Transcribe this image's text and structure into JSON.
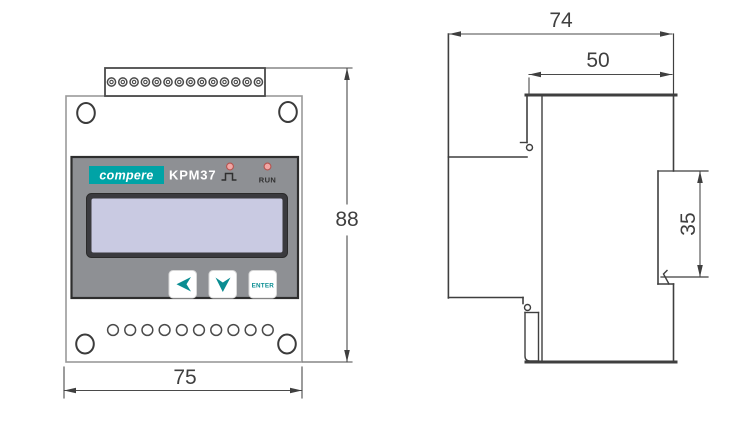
{
  "front": {
    "brand": "compere",
    "model": "KPM37",
    "leds": [
      {
        "name": "pulse",
        "icon": "pulse-waveform-icon"
      },
      {
        "name": "run",
        "label": "RUN"
      }
    ],
    "buttons": [
      {
        "name": "left",
        "icon": "left-arrow-icon"
      },
      {
        "name": "down",
        "icon": "down-arrow-icon"
      },
      {
        "name": "enter",
        "label": "ENTER"
      }
    ]
  },
  "dimensions": {
    "front_height": "88",
    "front_width": "75",
    "side_depth": "74",
    "upper_body_depth": "50",
    "din_rail_height": "35"
  },
  "colors": {
    "brand_teal": "#00A3A6",
    "button_glyph": "#0A8D92",
    "lcd": "#C9CAE2",
    "panel_gray": "#8E9094",
    "led_fill": "#F2A6A4",
    "led_border": "#B5534F",
    "line": "#3F3F3F"
  }
}
